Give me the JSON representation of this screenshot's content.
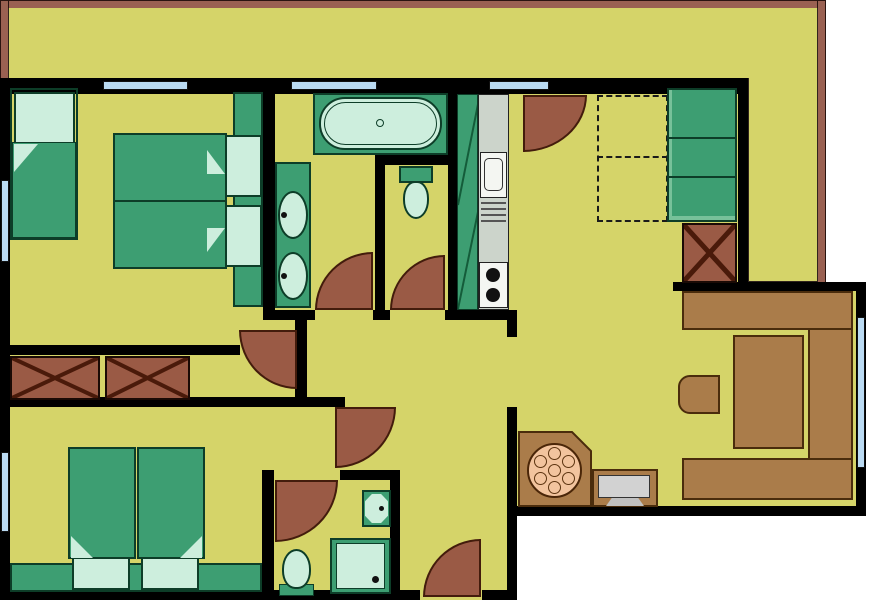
{
  "document": {
    "type": "architectural-floor-plan",
    "title": "Apartment floor plan (no text labels in drawing)",
    "visible_text": []
  },
  "colors": {
    "floor": "#d5d469",
    "wall": "#000000",
    "outside": "#ffffff",
    "furniture-green": "#3d9e72",
    "furniture-green-edge": "#0d3d28",
    "fixture-light": "#cdeedd",
    "door-brown": "#9a5a45",
    "door-edge": "#431c0c",
    "wood-brown": "#aa7c4a",
    "wood-edge": "#4a2c0c",
    "railing-brown": "#9a6152",
    "window-blue": "#badaf2",
    "counter-gray": "#ccd4cb",
    "fixture-white": "#f4f6f2",
    "tv-gray": "#d2d2d2",
    "table-salmon": "#f2c49e",
    "hatch-dark": "#555555"
  },
  "inventory": {
    "rooms": [
      "terrace-top",
      "terrace-right",
      "bedroom-top-left",
      "bathroom-top",
      "wc",
      "kitchen-nook",
      "hallway",
      "bedroom-bottom-left",
      "ensuite-bathroom",
      "entry-corridor",
      "living-room"
    ],
    "furniture": [
      "single-bed",
      "double-bed",
      "twin-beds",
      "headboard-panels",
      "hall-closet-x2",
      "shaft-box",
      "tall-cabinet",
      "dashed-overhead-unit",
      "sofa-u-shape",
      "coffee-table",
      "stool",
      "tv-on-stand",
      "round-dining-table-6-seats"
    ],
    "fixtures": [
      "bathtub",
      "double-washbasin",
      "toilet-x2",
      "small-basin",
      "shower",
      "kitchen-sink",
      "drainer",
      "cooktop-2-burners"
    ],
    "door_count": 7,
    "window_count": 6
  }
}
